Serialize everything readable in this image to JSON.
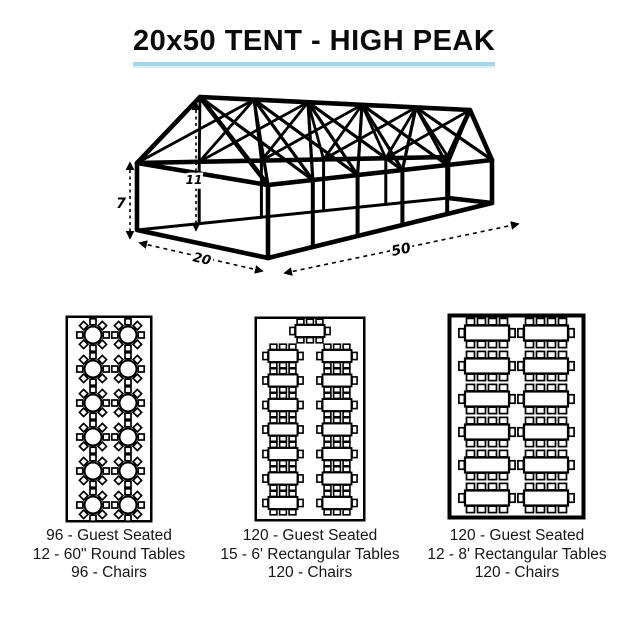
{
  "title": {
    "text": "20x50 TENT - HIGH PEAK"
  },
  "theme": {
    "underline_color": "#a5d7ea",
    "underline_color_light": "#d9eef7",
    "line_color": "#000000",
    "background": "#ffffff"
  },
  "tent_diagram": {
    "description": "3D wireframe of 20x50 high peak frame tent with cross bracing",
    "dimensions": {
      "wall_height": "7",
      "peak_height": "11",
      "width": "20",
      "length": "50"
    }
  },
  "layouts": [
    {
      "id": "round-tables",
      "type": "round",
      "table_count": 12,
      "rows": 6,
      "cols": 2,
      "chairs_per_table": 8,
      "caption": [
        "96 - Guest Seated",
        "12 - 60\" Round Tables",
        "96 - Chairs"
      ]
    },
    {
      "id": "rect-6ft",
      "type": "rect",
      "table_count": 15,
      "rows": 7,
      "cols": 2,
      "head_table": true,
      "chairs_per_table": 8,
      "caption": [
        "120 - Guest Seated",
        "15 - 6' Rectangular Tables",
        "120 - Chairs"
      ]
    },
    {
      "id": "rect-8ft",
      "type": "rect",
      "table_count": 12,
      "rows": 6,
      "cols": 2,
      "head_table": false,
      "chairs_per_table": 10,
      "caption": [
        "120 - Guest Seated",
        "12 - 8' Rectangular Tables",
        "120 - Chairs"
      ]
    }
  ]
}
